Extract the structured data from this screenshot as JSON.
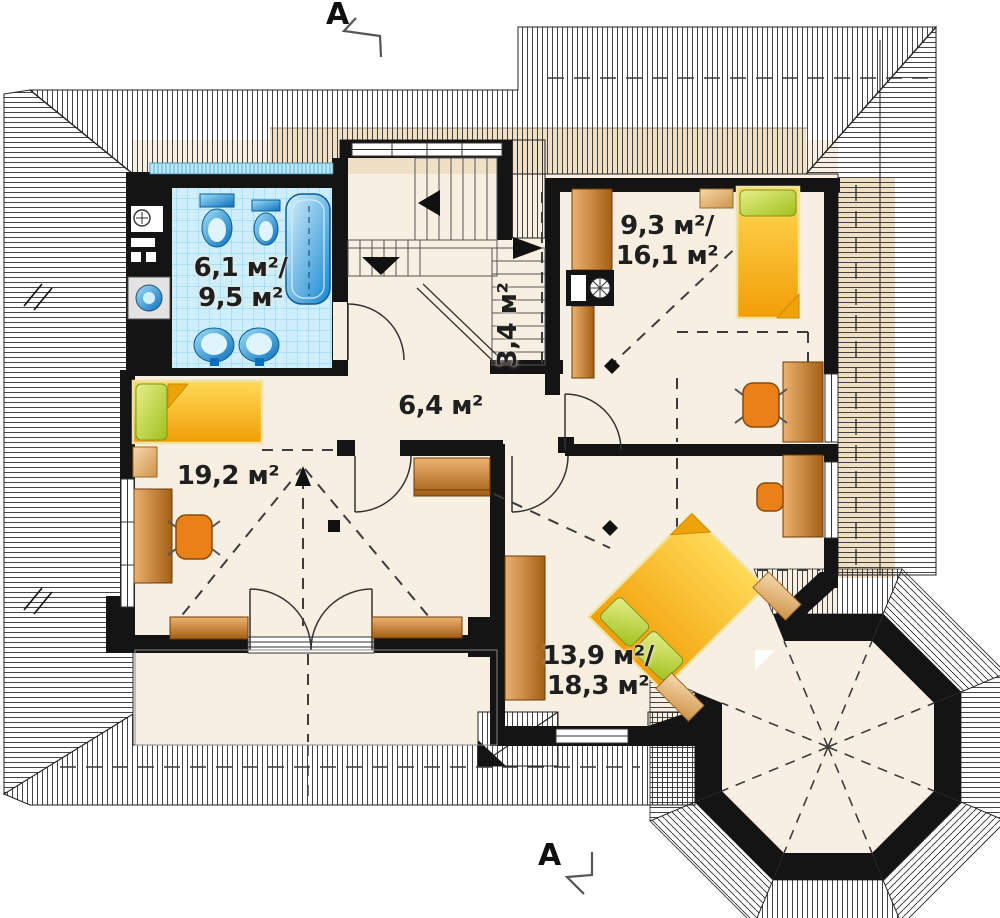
{
  "section_markers": {
    "top": "A",
    "bottom": "A"
  },
  "rooms": {
    "bathroom": {
      "line1": "6,1 м²/",
      "line2": "9,5 м²"
    },
    "staircase": {
      "line1": "3,4 м²"
    },
    "hall": {
      "line1": "6,4 м²"
    },
    "bedroom_left": {
      "line1": "19,2 м²"
    },
    "bedroom_top_right": {
      "line1": "9,3 м²/",
      "line2": "16,1 м²"
    },
    "bedroom_bottom_right": {
      "line1": "13,9 м²/",
      "line2": "18,3 м²"
    }
  },
  "icons": [
    "bathtub-icon",
    "toilet-icon",
    "bidet-icon",
    "sink-icon",
    "washing-machine-icon",
    "water-heater-icon",
    "bed-icon",
    "pillow-icon",
    "nightstand-icon",
    "desk-icon",
    "office-chair-icon",
    "stool-icon",
    "wardrobe-icon",
    "dresser-icon",
    "chimney-icon",
    "stair-direction-arrow-icon",
    "roof-window-icon",
    "section-cut-icon"
  ],
  "colors": {
    "floor": "#f7efe1",
    "wall": "#141414",
    "roof_line": "#2e2e2e",
    "roof_beige": "#efdfc5",
    "tile": "#cdeefa",
    "tile_grid": "#84d2ef",
    "fixture_blue": "#0c6fbe",
    "fixture_blue_light": "#9fe0f6",
    "bed_yellow": "#f6b113",
    "bed_yellow_light": "#ffd957",
    "pillow_green": "#b5cc3a",
    "wood": "#c07a2e",
    "wood_light": "#ecb271",
    "beige": "#e0b277",
    "chair_orange": "#ea8018",
    "label": "#1f1f1f"
  }
}
